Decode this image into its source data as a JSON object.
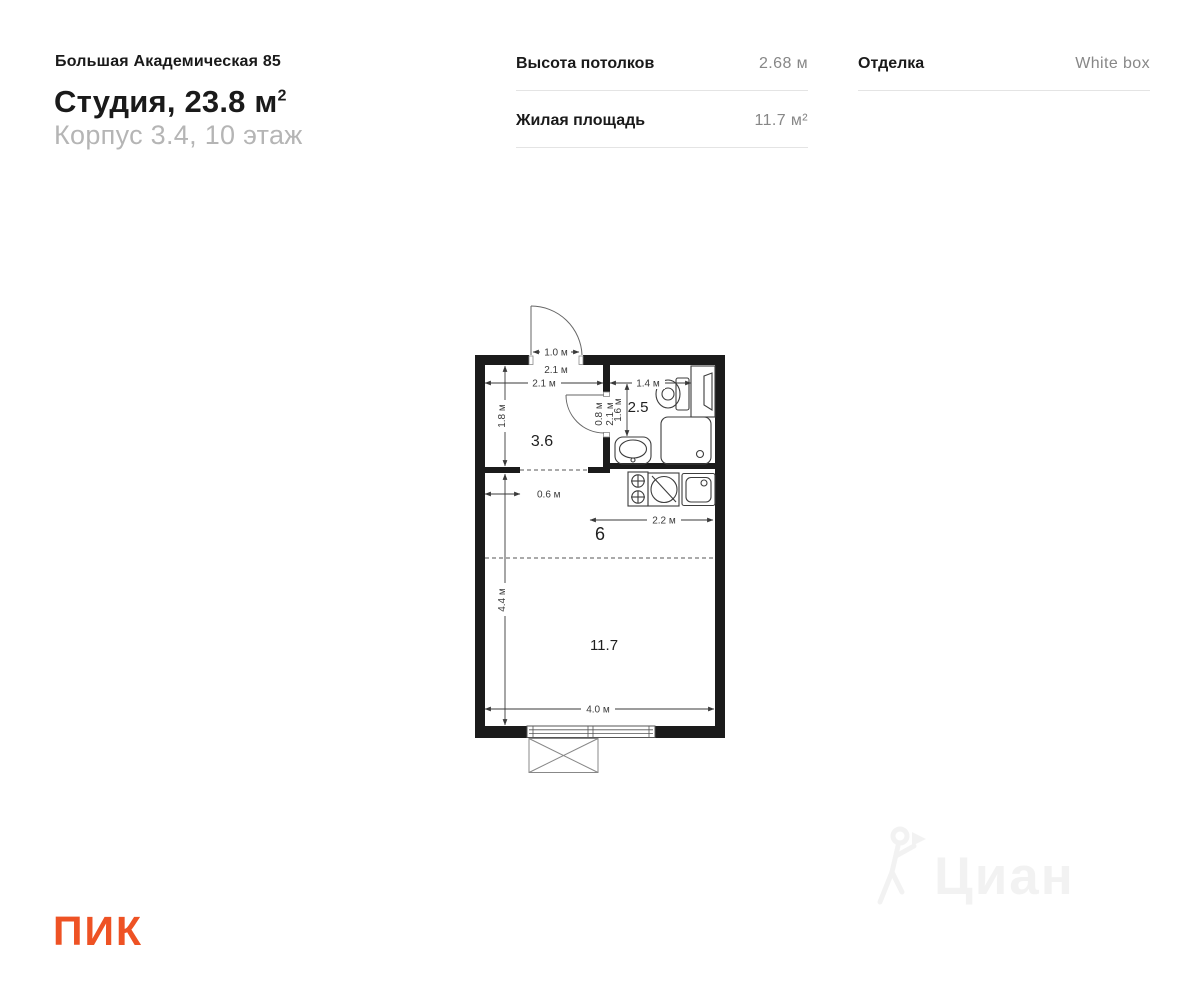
{
  "header": {
    "project": "Большая Академическая 85",
    "apartment_type": "Студия, 23.8 м",
    "area_superscript": "2",
    "building_floor": "Корпус 3.4, 10 этаж"
  },
  "specs": {
    "ceiling": {
      "label": "Высота потолков",
      "value": "2.68 м"
    },
    "living_area": {
      "label": "Жилая площадь",
      "value": "11.7 м²"
    },
    "finishing": {
      "label": "Отделка",
      "value": "White box"
    }
  },
  "plan": {
    "rooms": {
      "hallway": "3.6",
      "bathroom": "2.5",
      "kitchen": "6",
      "living": "11.7"
    },
    "dims": {
      "entry_door": "1.0 м",
      "hall_top": "2.1 м",
      "hall_width": "2.1 м",
      "hall_depth": "1.8 м",
      "bath_width": "1.4 м",
      "bath_depth": "1.6 м",
      "bath_door": "0.8 м",
      "bath_wall": "2.1 м",
      "ledge": "0.6 м",
      "kitchen_width": "2.2 м",
      "living_depth": "4.4 м",
      "living_width": "4.0 м"
    }
  },
  "watermark": {
    "text": "Циан"
  },
  "footer": {
    "logo_text": "ПИК"
  },
  "colors": {
    "brand_orange": "#EE5224",
    "wall": "#1b1b1b",
    "value_gray": "#878787"
  }
}
